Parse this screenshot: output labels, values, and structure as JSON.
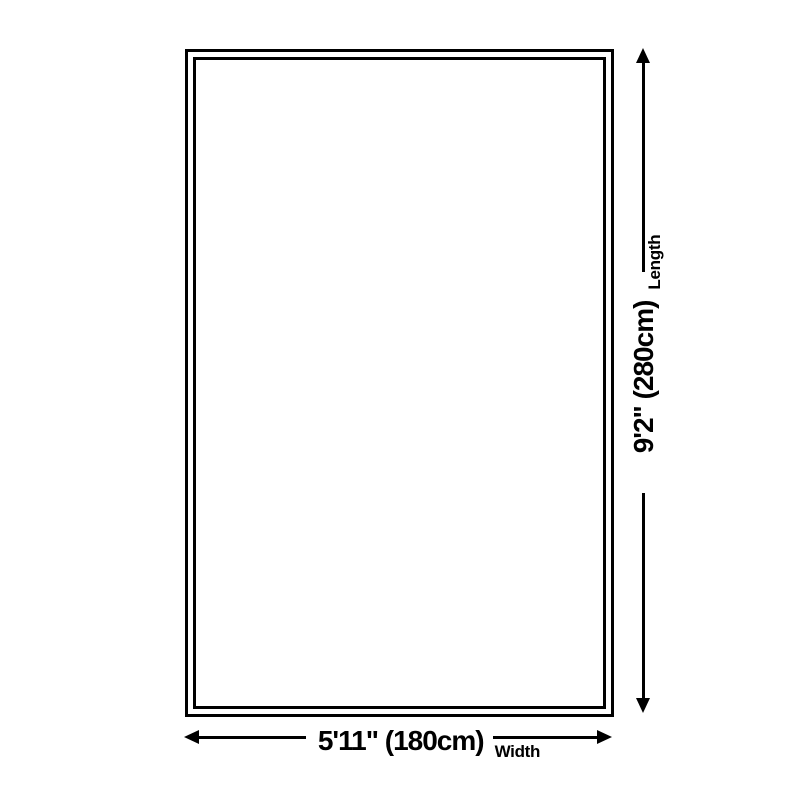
{
  "page": {
    "background_color": "#ffffff",
    "line_color": "#000000",
    "text_color": "#000000"
  },
  "diagram": {
    "type": "product-size-diagram",
    "shape": "rectangle-with-double-border",
    "length": {
      "value": "9'2\" (280cm)",
      "label": "Length"
    },
    "width": {
      "value": "5'11\" (180cm)",
      "label": "Width"
    }
  },
  "icons": {
    "arrow_up": "triangle-up",
    "arrow_down": "triangle-down",
    "arrow_left": "triangle-left",
    "arrow_right": "triangle-right"
  }
}
